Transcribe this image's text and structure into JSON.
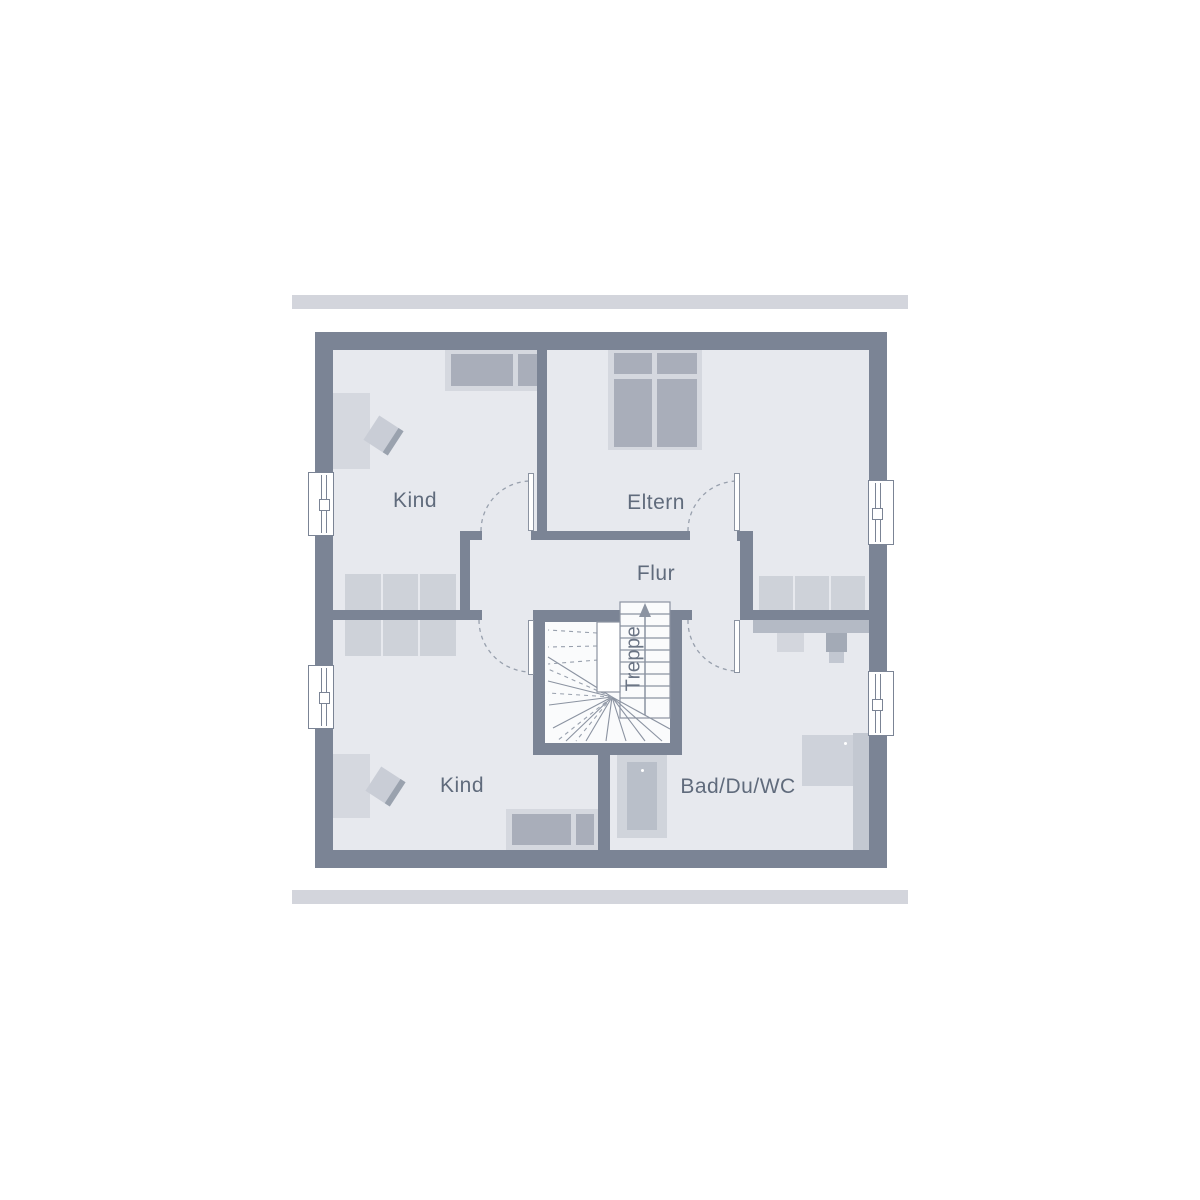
{
  "plan": {
    "title": "Obergeschoss Grundriss",
    "rooms": {
      "kind_top": {
        "label": "Kind"
      },
      "eltern": {
        "label": "Eltern"
      },
      "flur": {
        "label": "Flur"
      },
      "treppe": {
        "label": "Treppe"
      },
      "kind_bottom": {
        "label": "Kind"
      },
      "bad": {
        "label": "Bad/Du/WC"
      }
    },
    "colors": {
      "wall": "#7b8495",
      "floor": "#e7e9ee",
      "stair_floor": "#fafbfc",
      "furniture_light": "#d5d8df",
      "furniture_mid": "#ced2d9",
      "furniture_dark": "#a9aeba",
      "counter": "#b4bac5",
      "line": "#8b93a1",
      "label_text": "#606b7c",
      "rule_bar": "#d3d5dc"
    }
  }
}
